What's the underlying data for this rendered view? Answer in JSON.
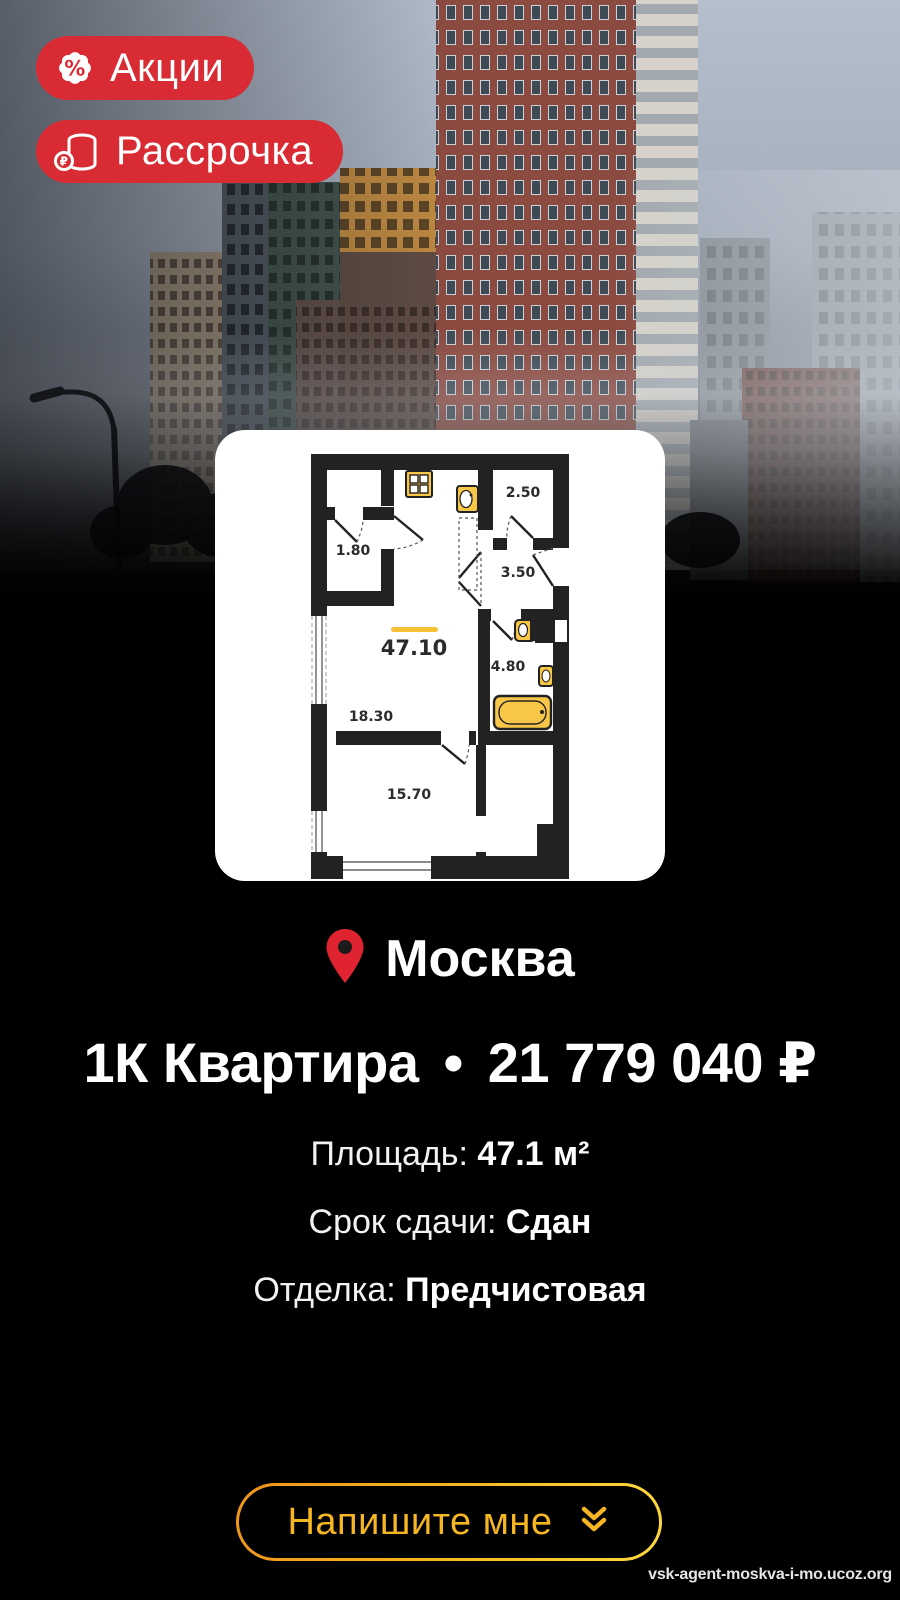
{
  "badges": [
    {
      "icon": "percent-badge-icon",
      "label": "Акции"
    },
    {
      "icon": "ruble-coins-icon",
      "label": "Рассрочка"
    }
  ],
  "floorplan": {
    "labels": {
      "total": "47.10",
      "r180": "1.80",
      "r250": "2.50",
      "r350": "3.50",
      "r480": "4.80",
      "r1830": "18.30",
      "r1570": "15.70"
    }
  },
  "location": {
    "city": "Москва"
  },
  "listing": {
    "type": "1К Квартира",
    "separator": "•",
    "price": "21 779 040 ₽"
  },
  "details": [
    {
      "label": "Площадь: ",
      "value": "47.1 м²"
    },
    {
      "label": "Срок сдачи: ",
      "value": "Сдан"
    },
    {
      "label": "Отделка: ",
      "value": "Предчистовая"
    }
  ],
  "cta": {
    "label": "Напишите мне",
    "icon": "double-chevron-down-icon"
  },
  "watermark": "vsk-agent-moskva-i-mo.ucoz.org",
  "colors": {
    "badge_red": "#d92b33",
    "pin_red": "#e02330",
    "gold": "#f6b522",
    "gold_light": "#ffd83e",
    "fixture_yellow": "#f9c748"
  }
}
